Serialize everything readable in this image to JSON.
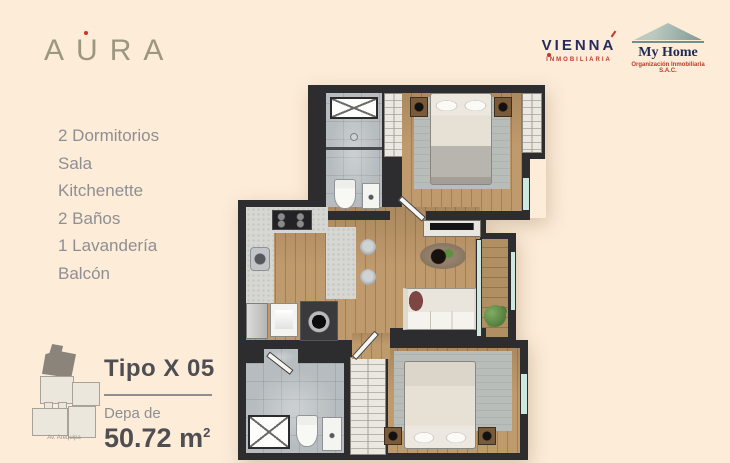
{
  "brand": {
    "name": "AÚRA",
    "display": [
      "A",
      "U",
      "RA"
    ]
  },
  "features": [
    "2 Dormitorios",
    "Sala",
    "Kitchenette",
    "2 Baños",
    "1 Lavandería",
    "Balcón"
  ],
  "unit": {
    "type_label": "Tipo X 05",
    "area_prefix": "Depa de",
    "area_value": "50.72",
    "area_unit_base": "m",
    "area_unit_sup": "2"
  },
  "minimap": {
    "street": "Av. Arequipa"
  },
  "logos": {
    "vienna": {
      "name": "VIENNA",
      "subtitle": "INMOBILIARIA"
    },
    "myhome": {
      "name": "My Home",
      "subtitle": "Organización Inmobiliaria S.A.C."
    }
  },
  "floorplan": {
    "rooms": [
      "bedroom-1",
      "bathroom-1",
      "kitchenette",
      "living-dining",
      "laundry",
      "balcony",
      "bedroom-2",
      "bathroom-2"
    ]
  },
  "colors": {
    "background": "#fcecd8",
    "brand_taupe": "#9d9681",
    "accent_red": "#c0392b",
    "navy": "#262a5e",
    "text_gray": "#8f8f93",
    "text_dark": "#4e4e53",
    "wall": "#2d2d2f",
    "wood": "#bf9a6d",
    "tile": "#b6bcbf",
    "counter": "#d6d7d3",
    "closet": "#ebe8e2",
    "rug": "#b9bdba",
    "glass": "#cde8e0",
    "bed_linen": "#e6e0d5",
    "roof_teal": "#7e9a95",
    "plant_green": "#57833f",
    "minimap_dark": "#8a847b",
    "minimap_light": "#ece7dc"
  }
}
